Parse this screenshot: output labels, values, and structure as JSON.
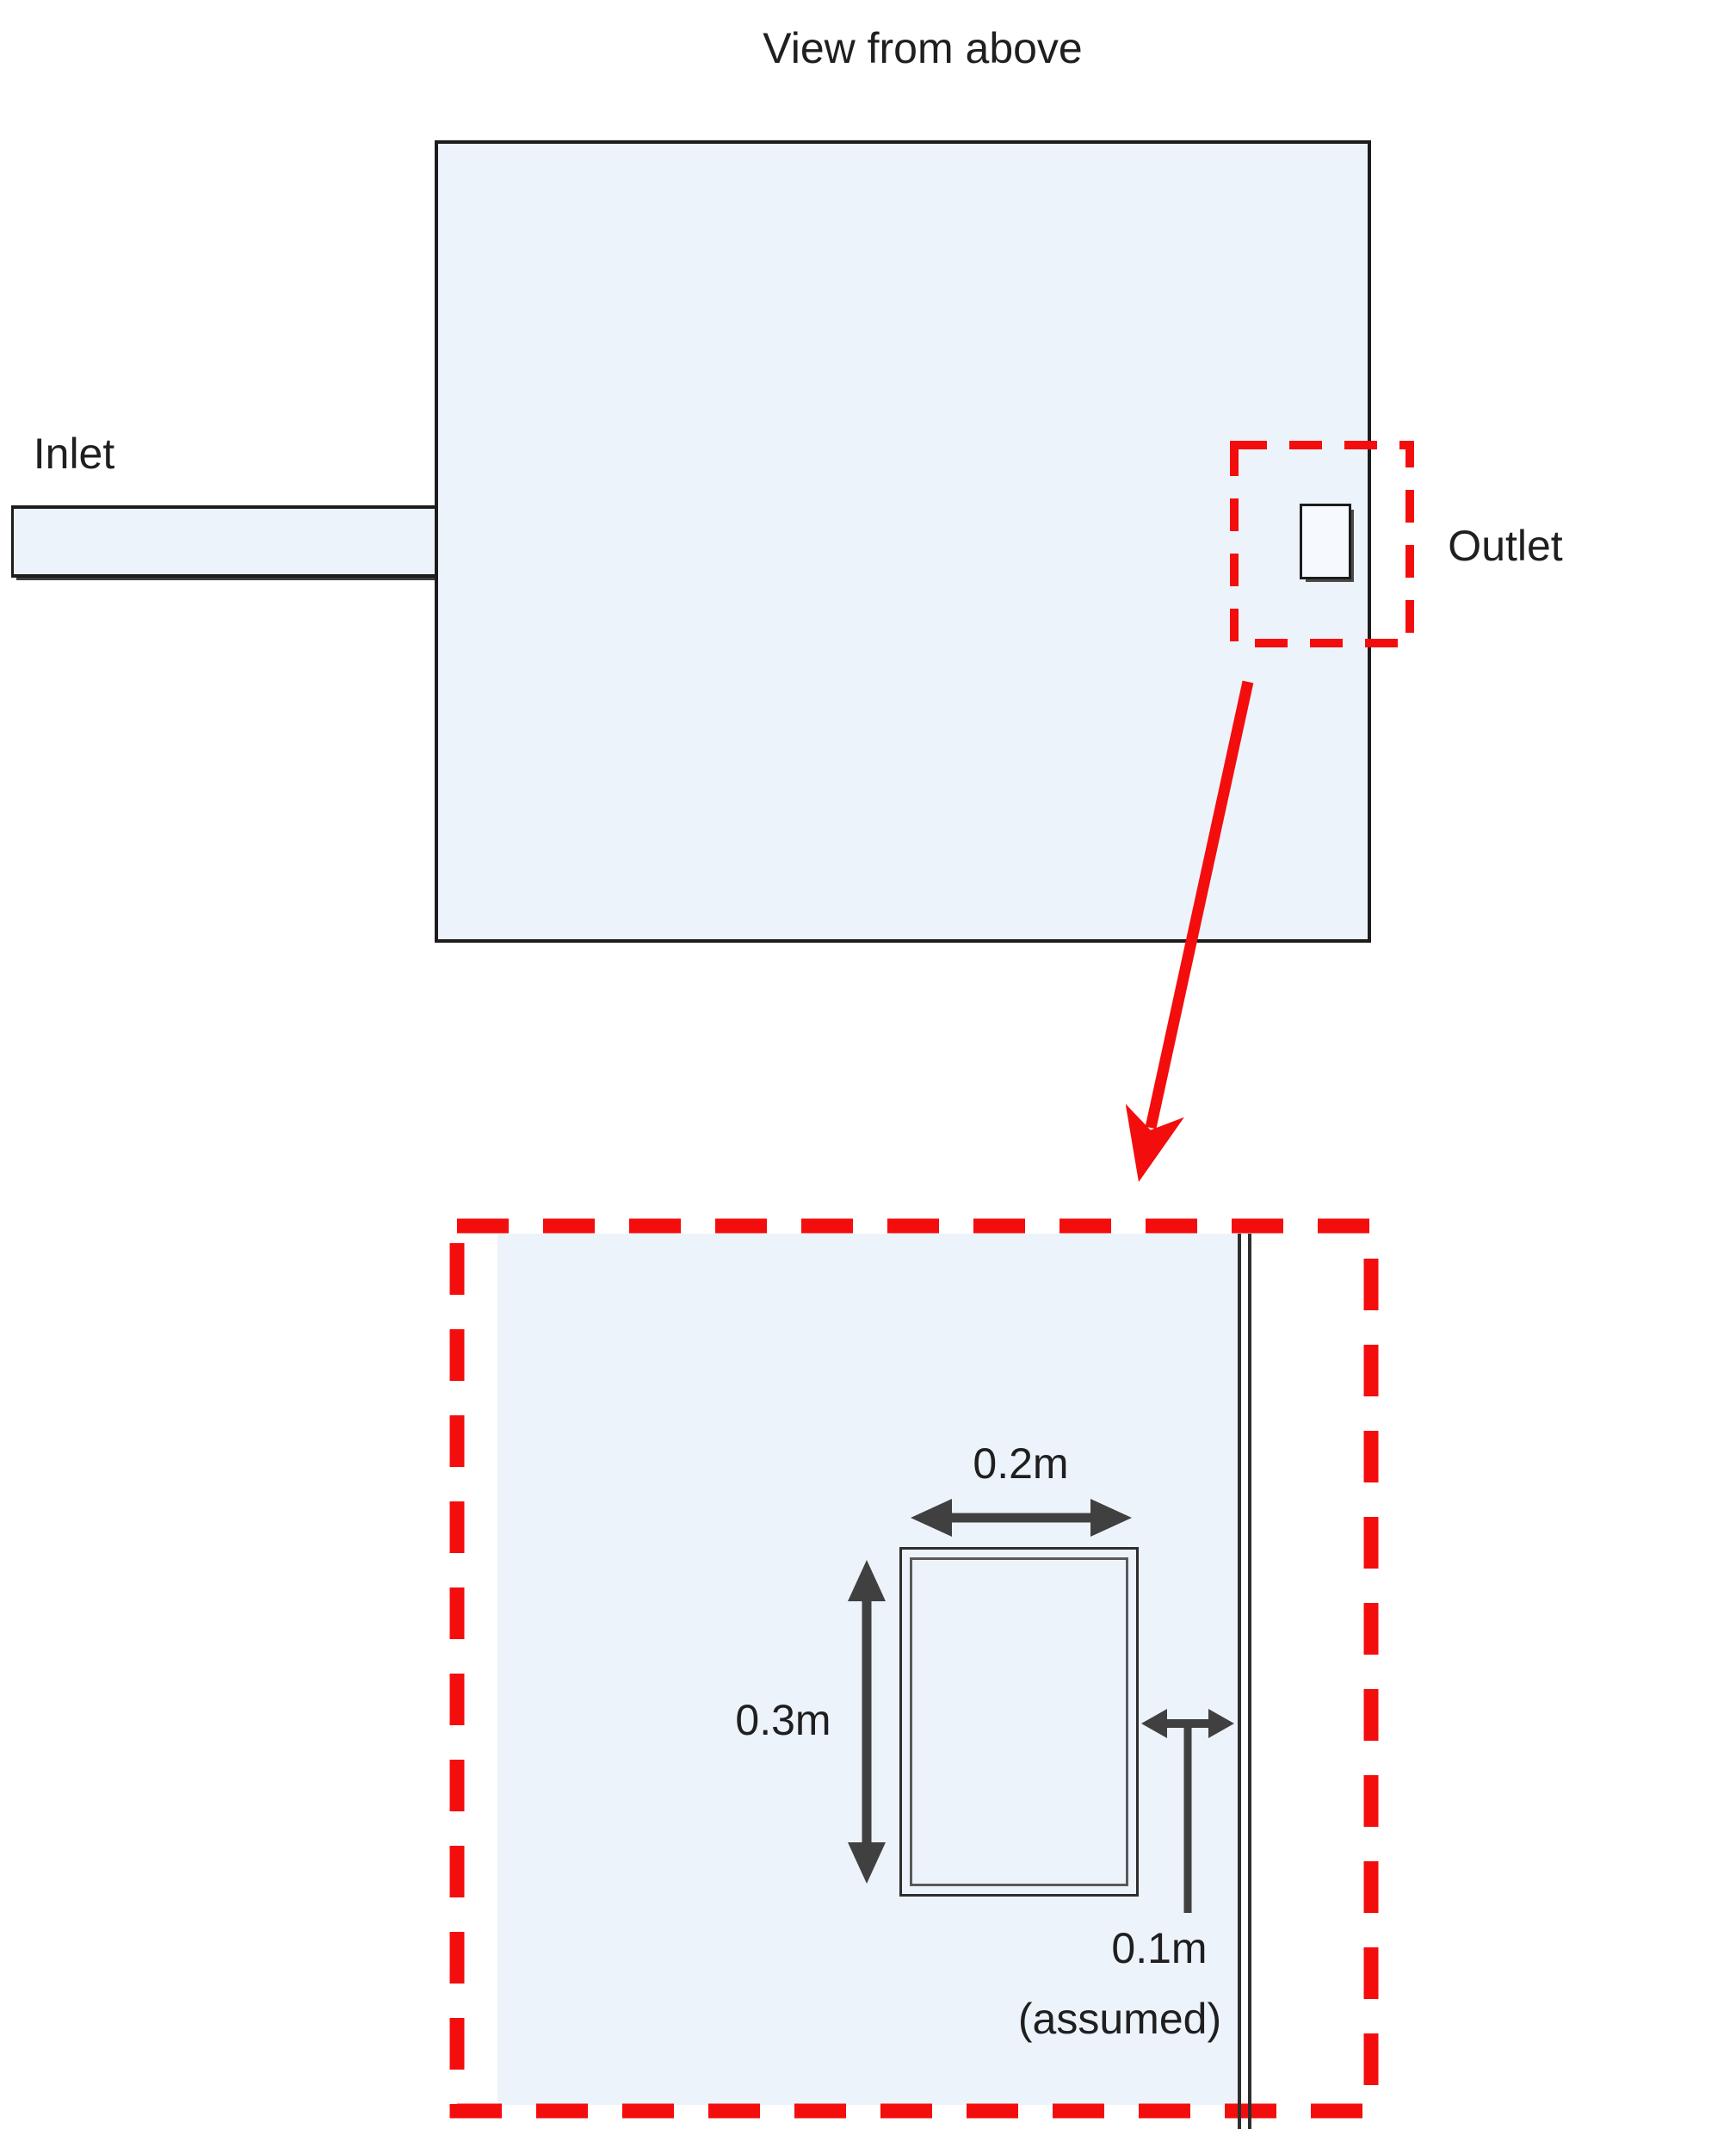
{
  "title": "View from above",
  "top_view": {
    "inlet_label": "Inlet",
    "outlet_label": "Outlet"
  },
  "detail_view": {
    "width_label": "0.2m",
    "height_label": "0.3m",
    "gap_label": "0.1m",
    "gap_note": "(assumed)"
  },
  "colors": {
    "tank-fill": "#edf3fb",
    "outline": "#1c1c1c",
    "highlight-red": "#f40d0d",
    "dimension-gray": "#404040",
    "text-color": "#1f1f1f"
  }
}
